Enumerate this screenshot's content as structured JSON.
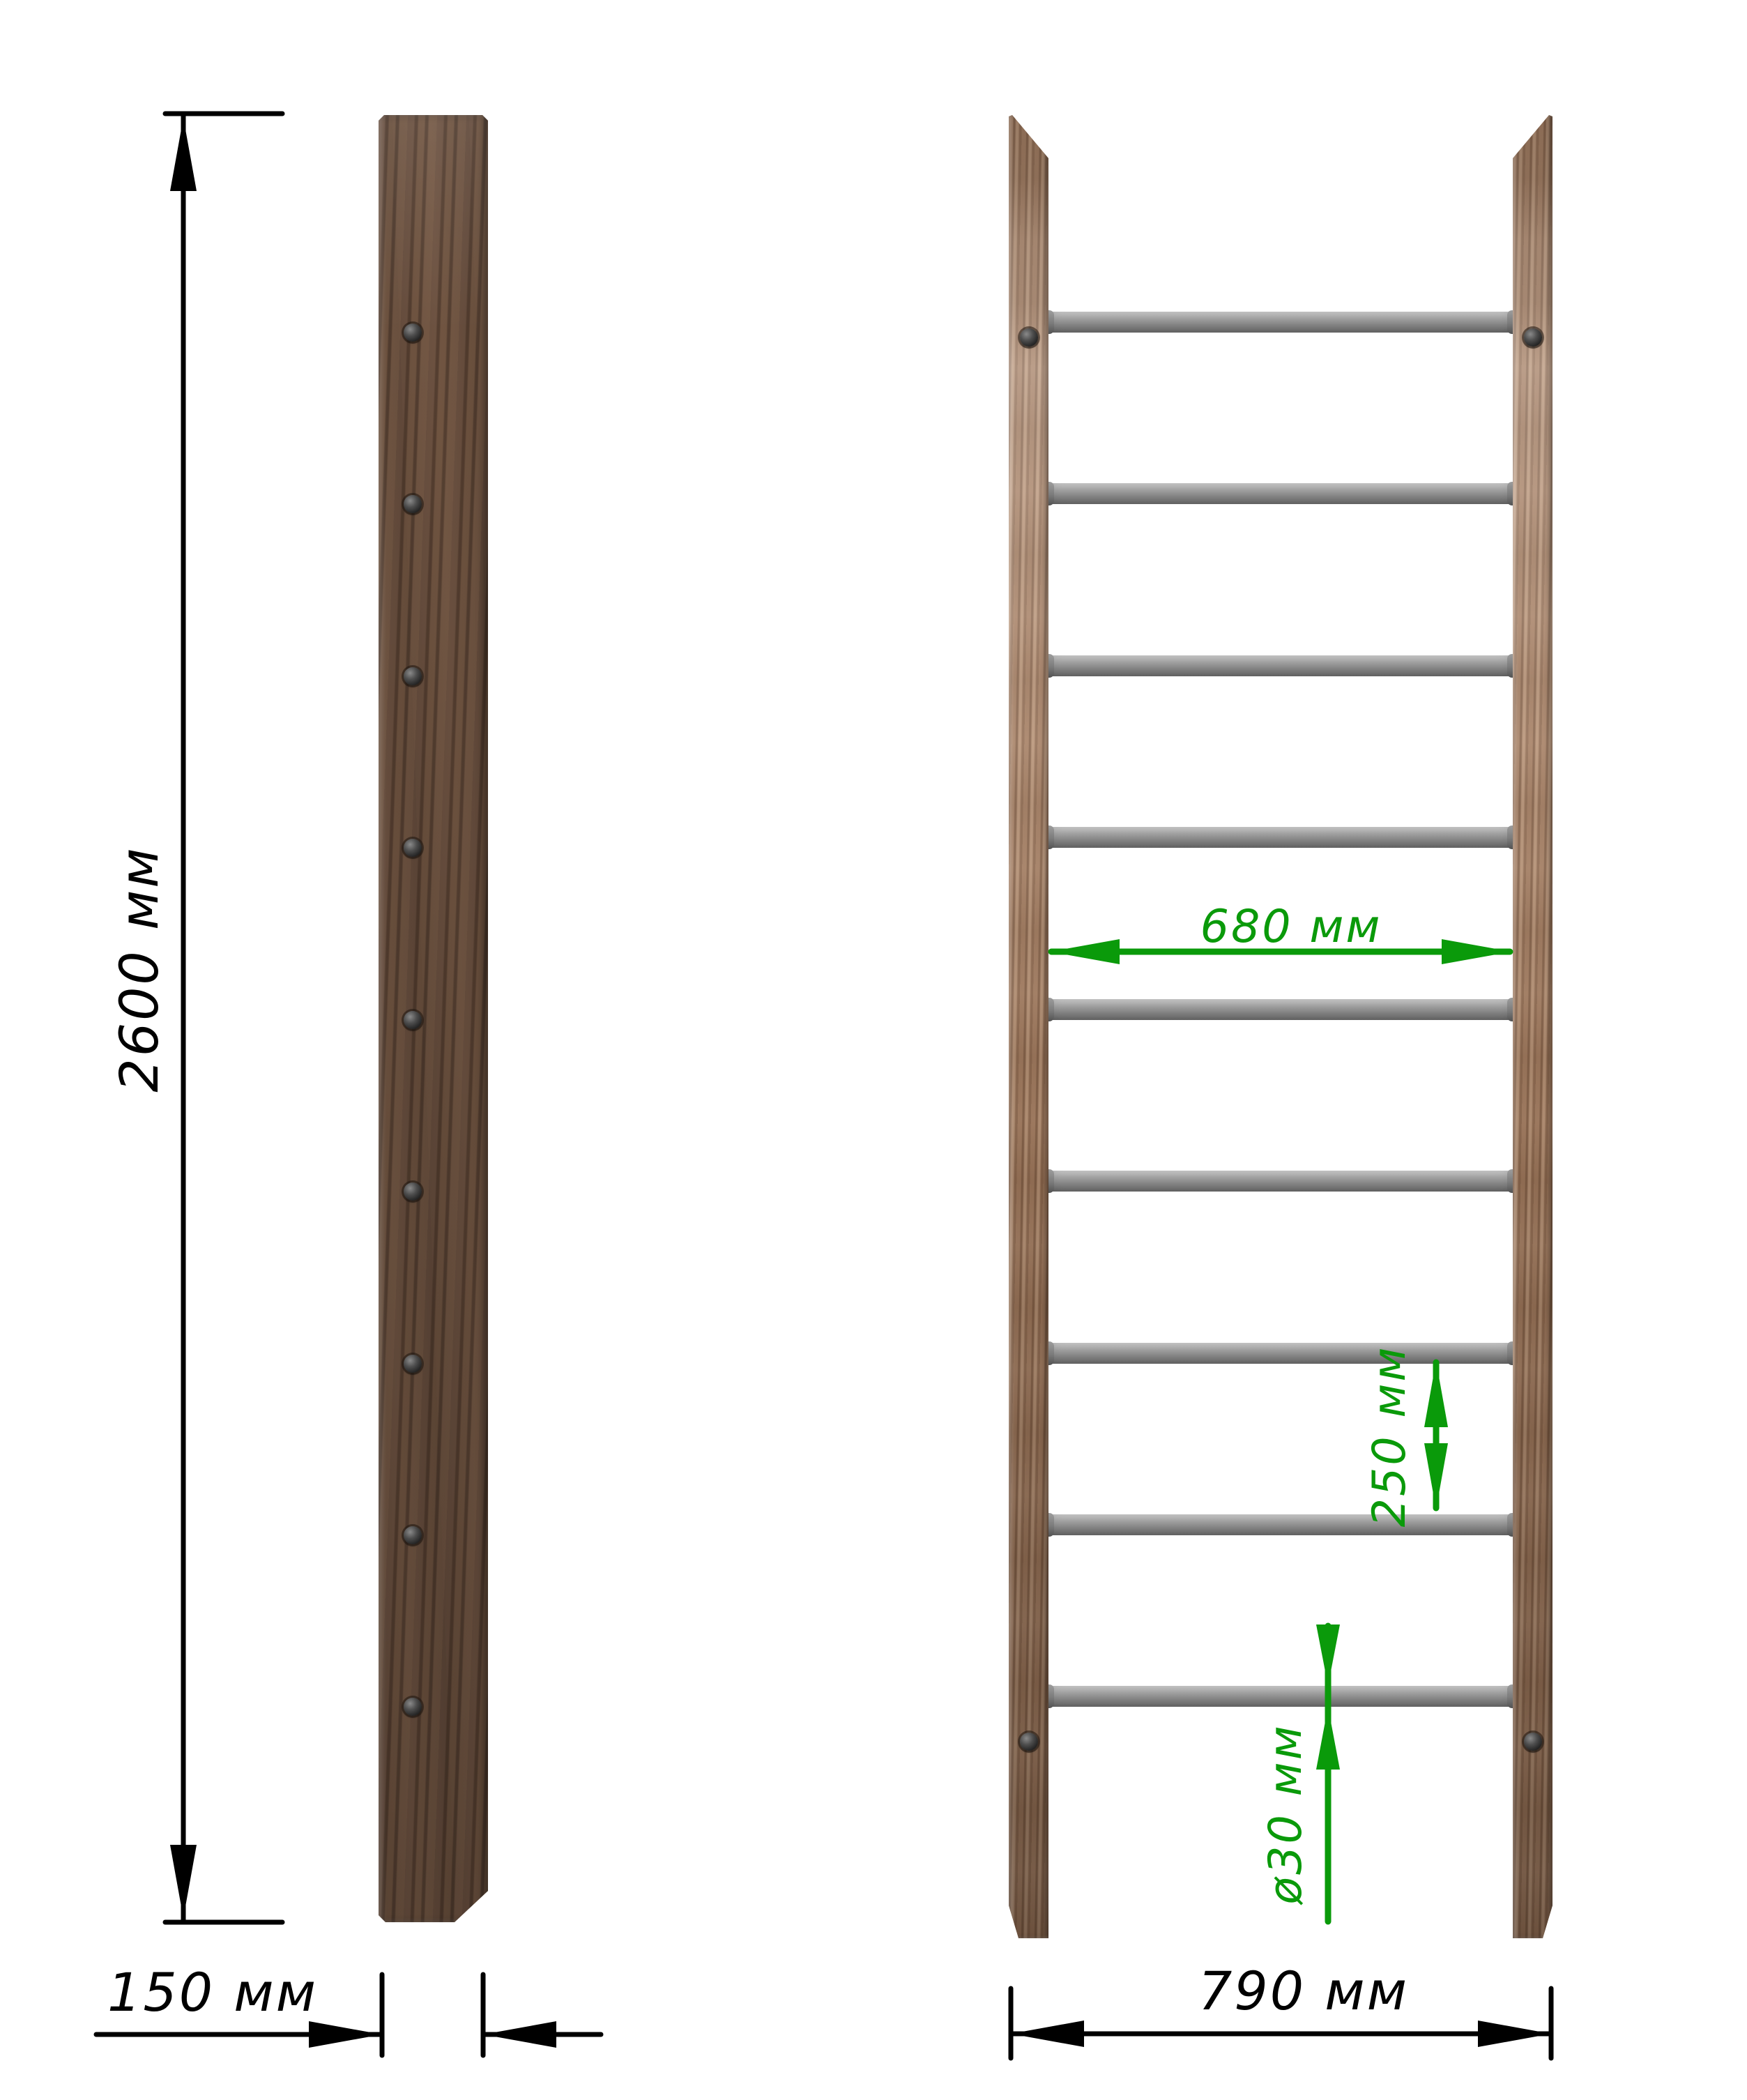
{
  "page": {
    "background": "#ffffff",
    "description": "Technical dimension drawing of a wooden wall-bar ladder: side view of stile and front view with metal rungs"
  },
  "side_view": {
    "name": "stile-side-view",
    "screw_count": 9
  },
  "front_view": {
    "name": "ladder-front-view",
    "rung_count": 9,
    "screw_count": 4
  },
  "dimensions": {
    "height": {
      "label": "2600 мм",
      "color": "#000000"
    },
    "depth": {
      "label": "150 мм",
      "color": "#000000"
    },
    "outer_width": {
      "label": "790 мм",
      "color": "#000000"
    },
    "inner_width": {
      "label": "680 мм",
      "color": "#0a9a0a"
    },
    "rung_spacing": {
      "label": "250 мм",
      "color": "#0a9a0a"
    },
    "rung_diameter": {
      "label": "ø30 мм",
      "color": "#0a9a0a"
    }
  },
  "colors": {
    "dimension_black": "#000000",
    "dimension_green": "#0a9a0a",
    "wood_side": "#6f5443",
    "wood_front": "#a27a5d",
    "rung_gray": "#8f8f8f",
    "screw_dark": "#2b2b2b",
    "background": "#ffffff"
  }
}
